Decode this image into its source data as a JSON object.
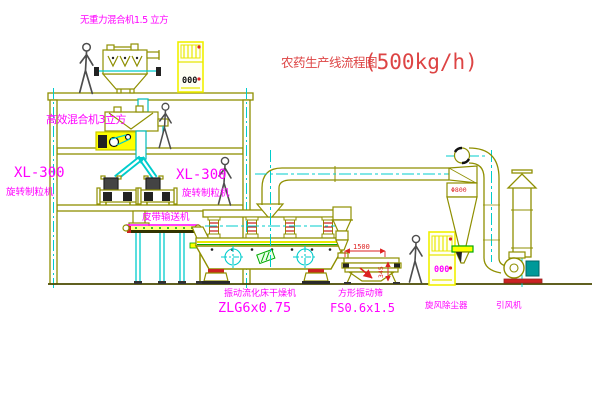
{
  "title": {
    "name": "农药生产线流程图",
    "capacity": "(500kg/h)"
  },
  "labels": {
    "top_mixer": "无重力混合机1.5 立方",
    "mixer2": "高效混合机3立方",
    "granulator_model_left": "XL-300",
    "granulator_name_left": "旋转制粒机",
    "granulator_model_mid": "XL-300",
    "granulator_name_mid": "旋转制粒机",
    "conveyor": "皮带输送机",
    "dryer_name": "振动流化床干燥机",
    "dryer_model": "ZLG6x0.75",
    "sieve_name": "方形振动筛",
    "sieve_model": "FS0.6x1.5",
    "cyclone": "旋风除尘器",
    "fan": "引风机"
  },
  "dimensions": {
    "sieve_length": "1500",
    "sieve_height": "345",
    "cyclone_diameter": "Φ800"
  },
  "cabinets": {
    "cabinet1_display": "000",
    "cabinet2_display": "000"
  },
  "colors": {
    "machine_line": "#8f8f00",
    "centerline_cyan": "#00cccc",
    "highlight_yellow": "#ffff00",
    "label_magenta": "#ff00ff",
    "dimension_red": "#dd2222",
    "title_red": "#dd4444"
  }
}
